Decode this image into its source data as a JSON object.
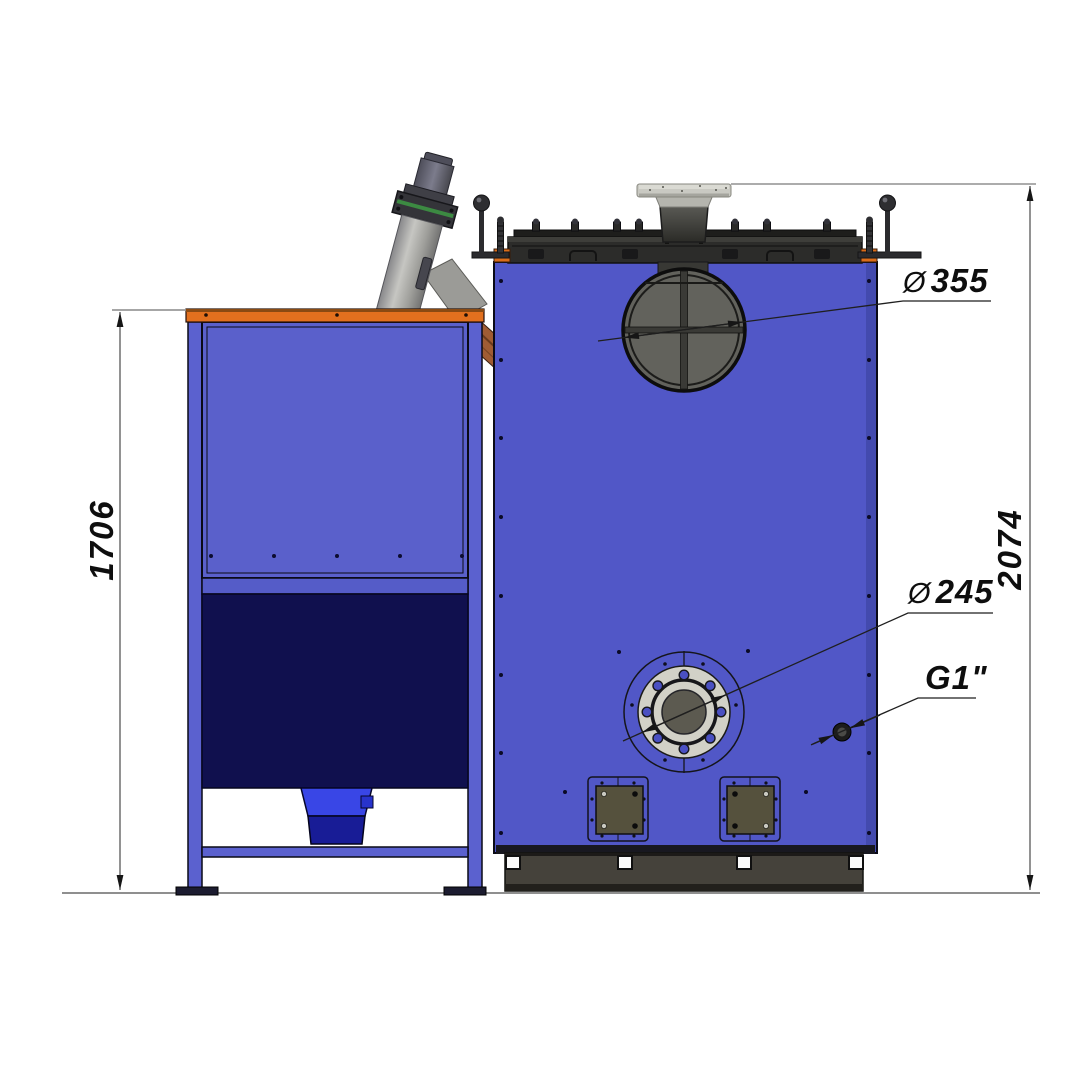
{
  "drawing": {
    "dimensions": {
      "hopper_height": {
        "value": "1706"
      },
      "overall_height": {
        "value": "2074"
      }
    },
    "callouts": {
      "flue_diameter": {
        "symbol": "Ø",
        "value": "355"
      },
      "flange_diameter": {
        "symbol": "Ø",
        "value": "245"
      },
      "pipe_thread": {
        "symbol": "",
        "value": "G1\""
      }
    },
    "colors": {
      "boiler_body_blue": "#5157c7",
      "hopper_panel_blue": "#5a60cb",
      "hopper_lower_navy": "#10104e",
      "funnel_blue": "#3946e6",
      "trim_orange": "#dd6e1b",
      "lid_dark_gray": "#2c2c2a",
      "base_gray": "#45423b",
      "flange_light_gray": "#d2d1c7",
      "auger_gray": "#a8a8a6",
      "chute_brown": "#a05c34"
    }
  }
}
